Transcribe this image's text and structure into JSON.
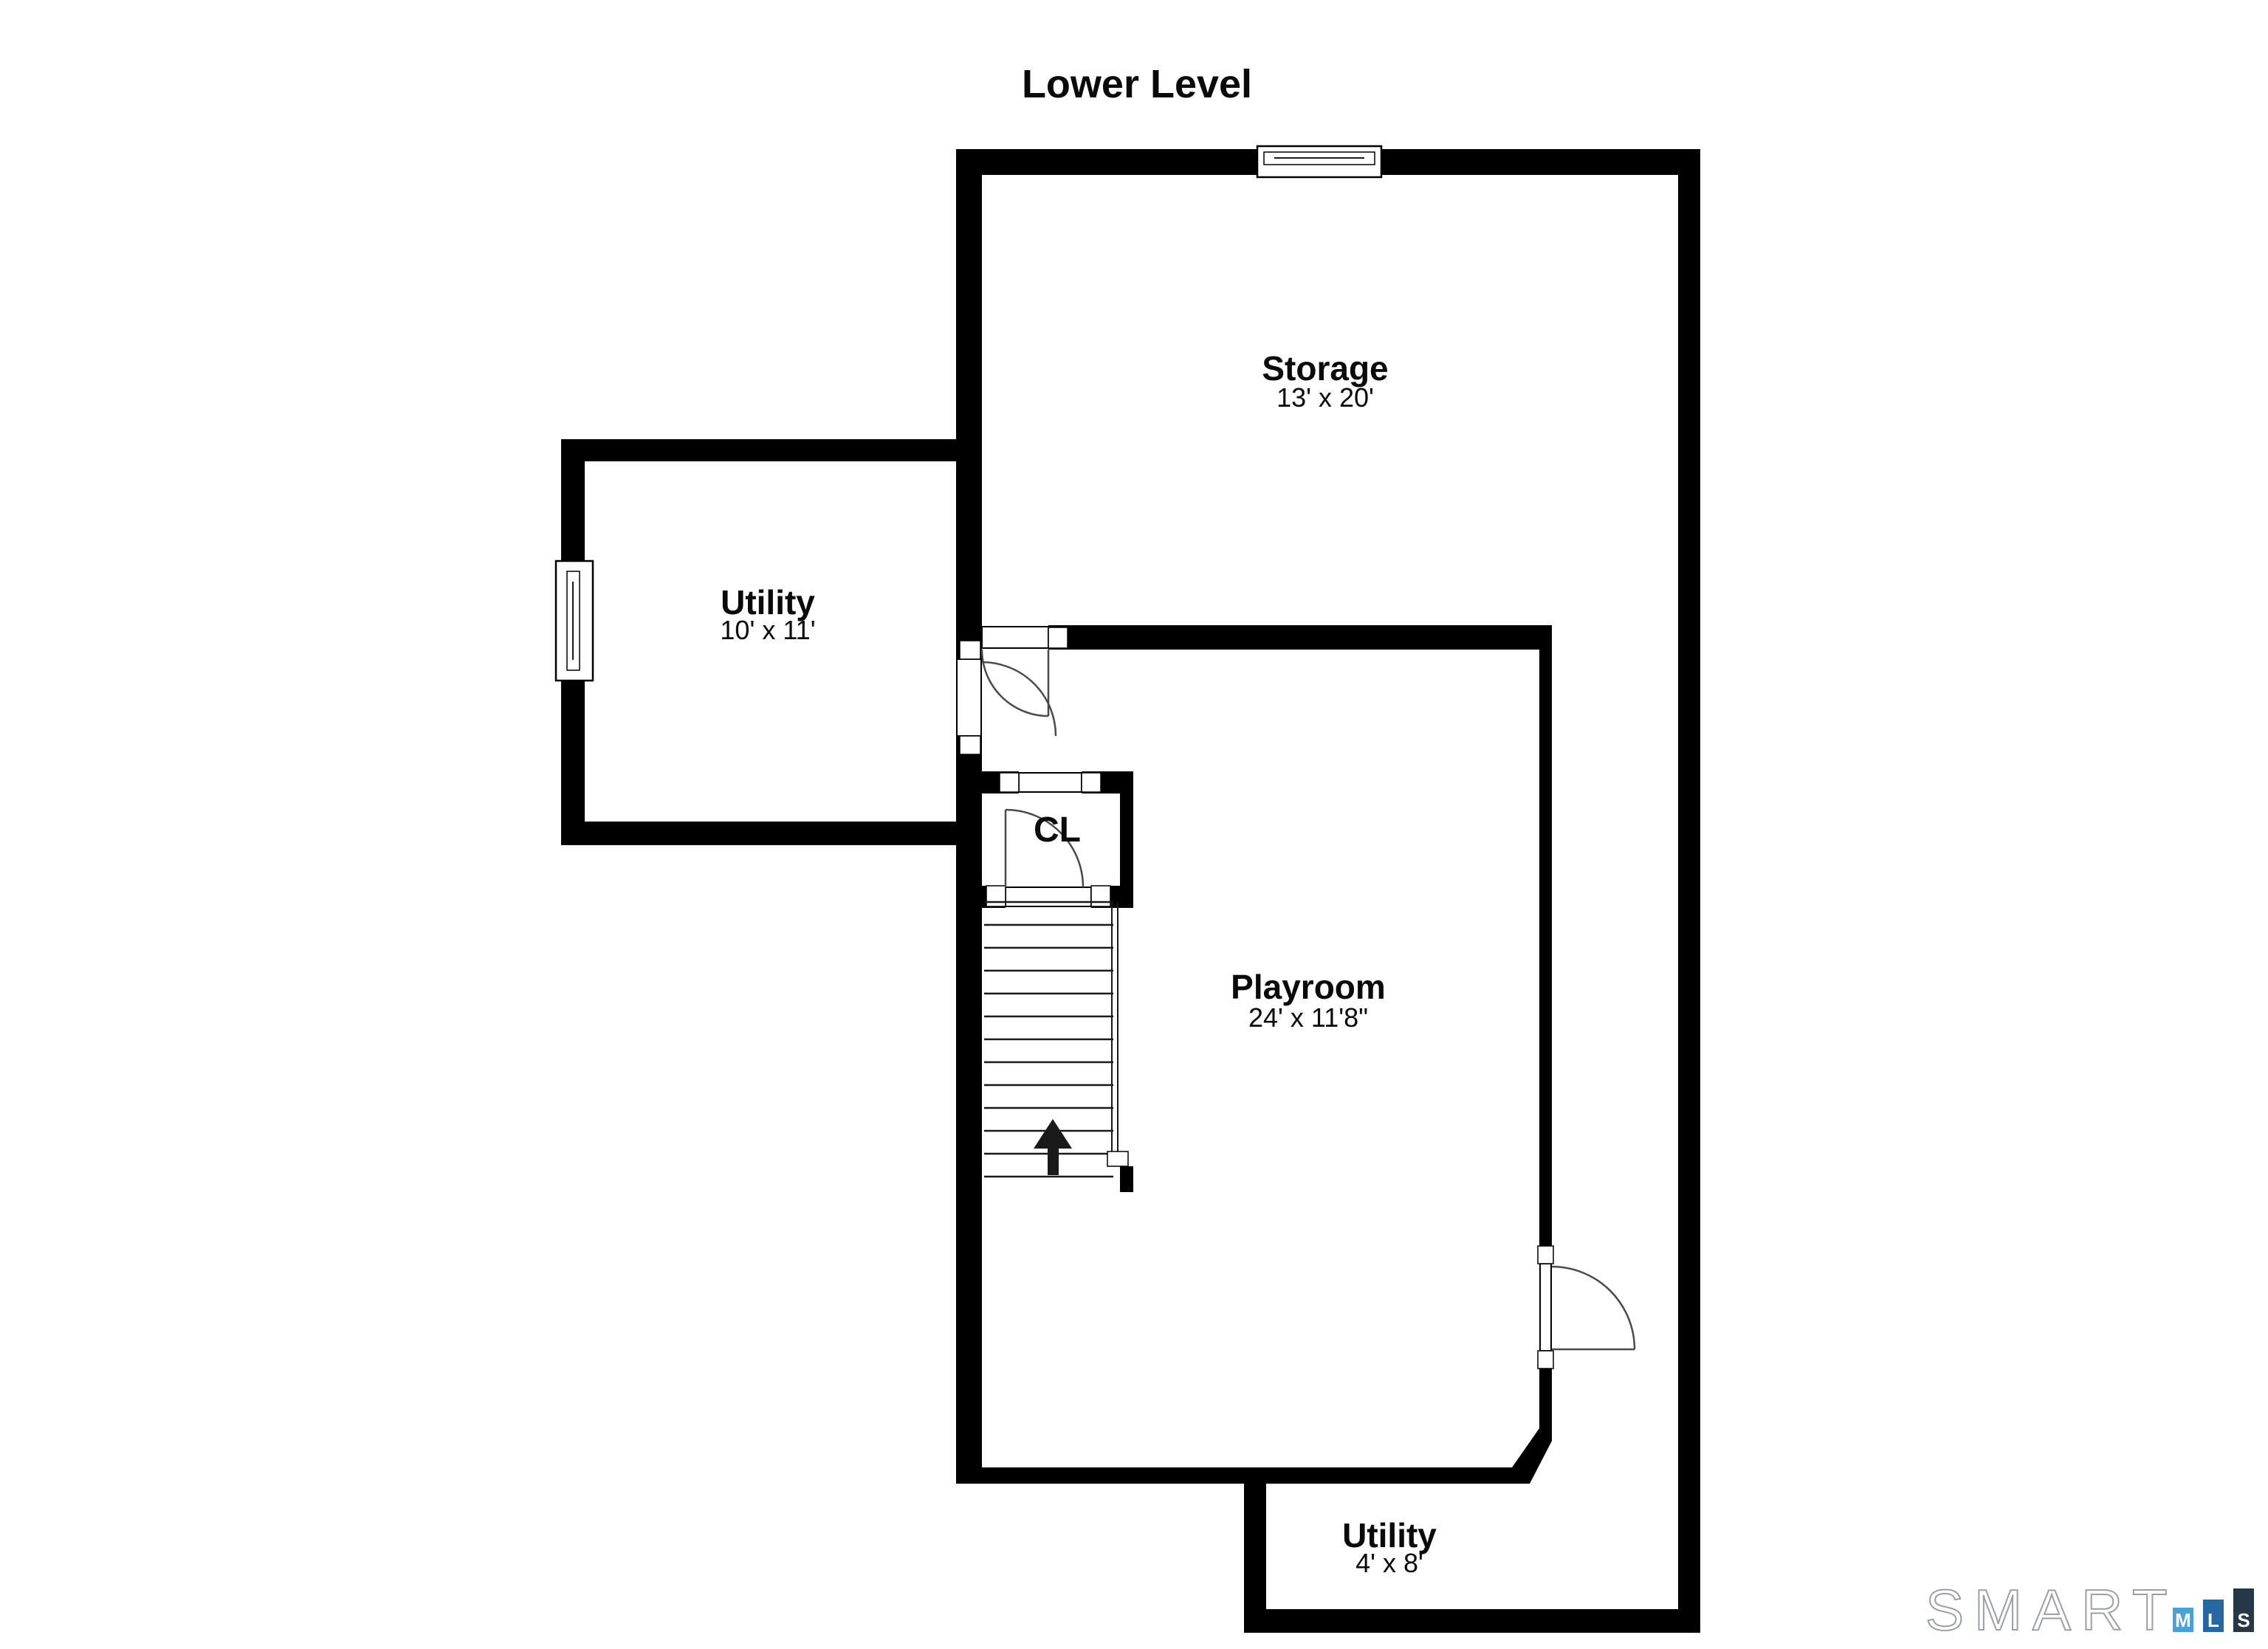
{
  "title": "Lower Level",
  "rooms": {
    "storage": {
      "name": "Storage",
      "dims": "13' x 20'"
    },
    "utility_upper": {
      "name": "Utility",
      "dims": "10' x 11'"
    },
    "closet": {
      "name": "CL"
    },
    "playroom": {
      "name": "Playroom",
      "dims": "24' x 11'8\""
    },
    "utility_lower": {
      "name": "Utility",
      "dims": "4' x 8'"
    }
  },
  "stairs": {
    "direction": "up"
  },
  "logo": {
    "brand": "SMART",
    "m": "M",
    "l": "L",
    "s": "S",
    "colors": {
      "m_box": "#4AA0D9",
      "l_box": "#2566A3",
      "s_box": "#25384A",
      "outline": "#9AA0A6"
    }
  },
  "colors": {
    "wall": "#000000",
    "background": "#FFFFFF"
  }
}
